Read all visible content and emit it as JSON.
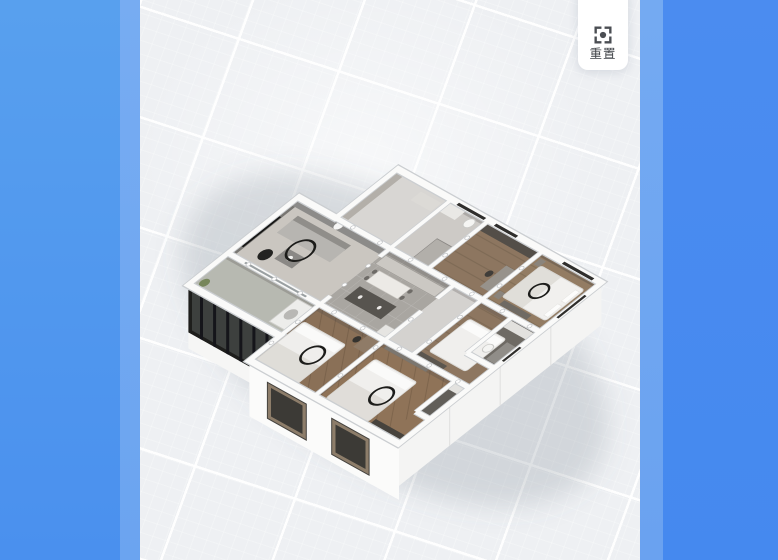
{
  "toolbar": {
    "reset_button": {
      "label": "重置",
      "icon": "focus-reset-icon"
    }
  },
  "viewport": {
    "background_color": "#eef0f3",
    "grid_line_color": "#ffffff",
    "left_panel_color": "#4a90ee",
    "left_panel_light_color": "#6ba4f0",
    "right_panel_color": "#4589ef",
    "right_panel_light_color": "#6aa2f0"
  },
  "scene": {
    "type": "3d-floorplan-model",
    "style": "isometric-cutaway",
    "wall_color": "#fafaf9",
    "balcony_glazing_color": "#1e1e1c",
    "ceiling_lamp_color": "#1c1c1a",
    "rooms": [
      {
        "name": "living-room",
        "floor_color": "#cac6c0"
      },
      {
        "name": "balcony",
        "floor_color": "#b7b9b1"
      },
      {
        "name": "kitchen-dining",
        "floor_color": "#a9a6a1"
      },
      {
        "name": "foyer",
        "floor_color": "#d8d6d3"
      },
      {
        "name": "bathroom-north",
        "floor_color": "#cdcac6"
      },
      {
        "name": "bedroom-north",
        "floor_color": "#8d7660"
      },
      {
        "name": "bedroom-northeast",
        "floor_color": "#937c63"
      },
      {
        "name": "hallway",
        "floor_color": "#d4d2cf"
      },
      {
        "name": "bedroom-east",
        "floor_color": "#8d7660"
      },
      {
        "name": "bathroom-east",
        "floor_color": "#6e6a64"
      },
      {
        "name": "bedroom-south",
        "floor_color": "#8a7057"
      },
      {
        "name": "master-bedroom",
        "floor_color": "#8f7358"
      },
      {
        "name": "master-bathroom",
        "floor_color": "#615e59"
      }
    ]
  }
}
